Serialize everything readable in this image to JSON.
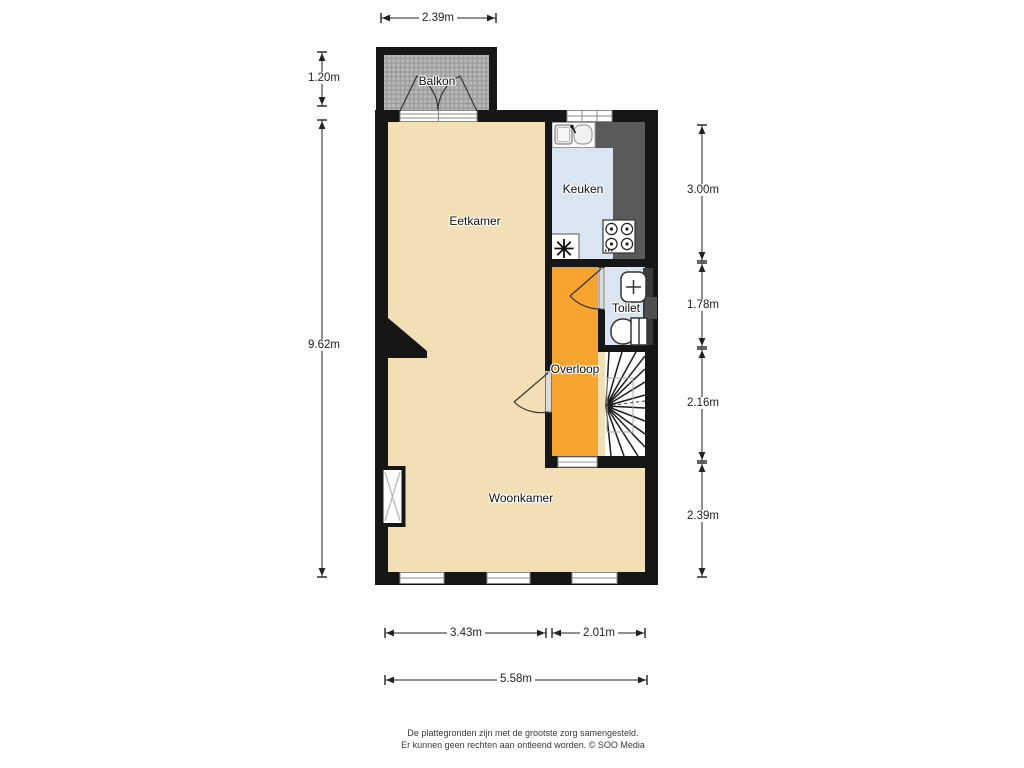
{
  "plan": {
    "rooms": [
      {
        "name": "balkon",
        "label": "Balkon"
      },
      {
        "name": "eetkamer",
        "label": "Eetkamer"
      },
      {
        "name": "keuken",
        "label": "Keuken"
      },
      {
        "name": "toilet",
        "label": "Toilet"
      },
      {
        "name": "overloop",
        "label": "Overloop"
      },
      {
        "name": "woonkamer",
        "label": "Woonkamer"
      }
    ],
    "fixtures": [
      "kitchen-sink",
      "stove",
      "boiler",
      "hand-basin",
      "toilet-bowl",
      "staircase",
      "radiator",
      "balcony-double-doors",
      "windows"
    ],
    "colors": {
      "floor": "#f2dfb6",
      "landing": "#f7a42f",
      "kitchen_floor": "#d9e5f0",
      "counter": "#5a5a5a",
      "wall": "#161616",
      "balcony_hatch": "#a8a8a8"
    }
  },
  "dimensions": {
    "top": [
      {
        "label": "2.39m"
      }
    ],
    "left": [
      {
        "label": "1.20m"
      },
      {
        "label": "9.62m"
      }
    ],
    "right": [
      {
        "label": "3.00m"
      },
      {
        "label": "1.78m"
      },
      {
        "label": "2.16m"
      },
      {
        "label": "2.39m"
      }
    ],
    "bottom": [
      {
        "label": "3.43m"
      },
      {
        "label": "2.01m"
      },
      {
        "label": "5.58m"
      }
    ]
  },
  "footer": {
    "line1": "De plattegronden zijn met de grootste zorg samengesteld.",
    "line2": "Er kunnen geen rechten aan ontleend worden. © SOO Media"
  }
}
